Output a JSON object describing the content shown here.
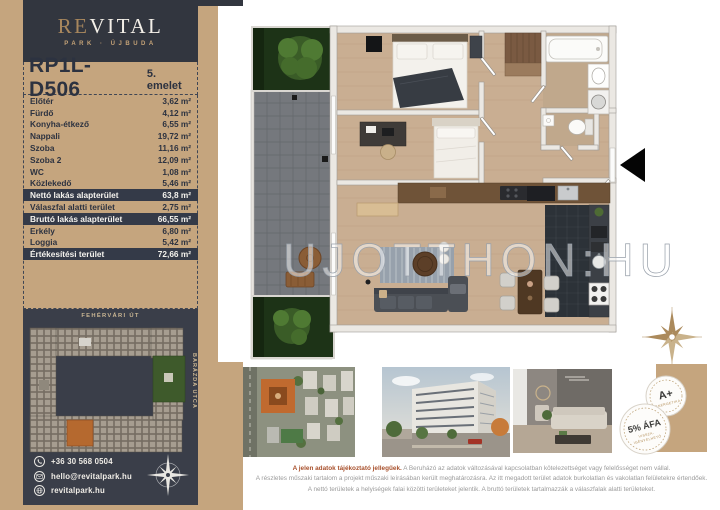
{
  "brand": {
    "name_left": "RE",
    "name_right": "VITAL",
    "subtitle": "PARK · ÚJBUDA"
  },
  "unit": {
    "code": "RP1L-D506",
    "floor": "5. emelet"
  },
  "areas": {
    "rows": [
      {
        "label": "Előtér",
        "value": "3,62 m²"
      },
      {
        "label": "Fürdő",
        "value": "4,12 m²"
      },
      {
        "label": "Konyha-étkező",
        "value": "6,55 m²"
      },
      {
        "label": "Nappali",
        "value": "19,72 m²"
      },
      {
        "label": "Szoba",
        "value": "11,16 m²"
      },
      {
        "label": "Szoba 2",
        "value": "12,09 m²"
      },
      {
        "label": "WC",
        "value": "1,08 m²"
      },
      {
        "label": "Közlekedő",
        "value": "5,46 m²"
      },
      {
        "label": "Nettó lakás alapterület",
        "value": "63,8 m²"
      },
      {
        "label": "Válaszfal alatti terület",
        "value": "2,75 m²"
      },
      {
        "label": "Bruttó lakás alapterület",
        "value": "66,55 m²"
      },
      {
        "label": "Erkély",
        "value": "6,80 m²"
      },
      {
        "label": "Loggia",
        "value": "5,42 m²"
      },
      {
        "label": "Értékesítési terület",
        "value": "72,66 m²"
      }
    ]
  },
  "sitemap": {
    "street_top": "FEHÉRVÁRI ÚT",
    "street_right": "BARÁZDA UTCA"
  },
  "contact": {
    "phone": "+36 30 568 0504",
    "email": "hello@revitalpark.hu",
    "website": "revitalpark.hu"
  },
  "watermark": "UJOTTHON:HU",
  "badges": {
    "energy": {
      "title": "A+",
      "subtitle": "ENERGETIKA"
    },
    "vat": {
      "title": "5% ÁFA",
      "subtitle_line1": "VISSZA-",
      "subtitle_line2": "IGÉNYELHETŐ"
    }
  },
  "disclaimer": {
    "intro": "A jelen adatok tájékoztató jellegűek.",
    "line1": "A Beruházó az adatok változásával kapcsolatban kötelezettséget vagy felelősséget nem vállal.",
    "line2": "A részletes műszaki tartalom a projekt műszaki leírásában került meghatározásra. Az itt megadott terület adatok burkolatlan és vakolatlan felületekre értendőek.",
    "line3": "A nettó területek a helyiségek falai közötti területeket jelentik. A bruttó területek tartalmazzák a válaszfalak alatti területeket."
  },
  "colors": {
    "accent_tan": "#c5a57e",
    "panel_dark": "#32363f",
    "row_highlight": "#343a48",
    "unit_orange": "#b5692f",
    "disclaimer_accent": "#a8502c"
  }
}
